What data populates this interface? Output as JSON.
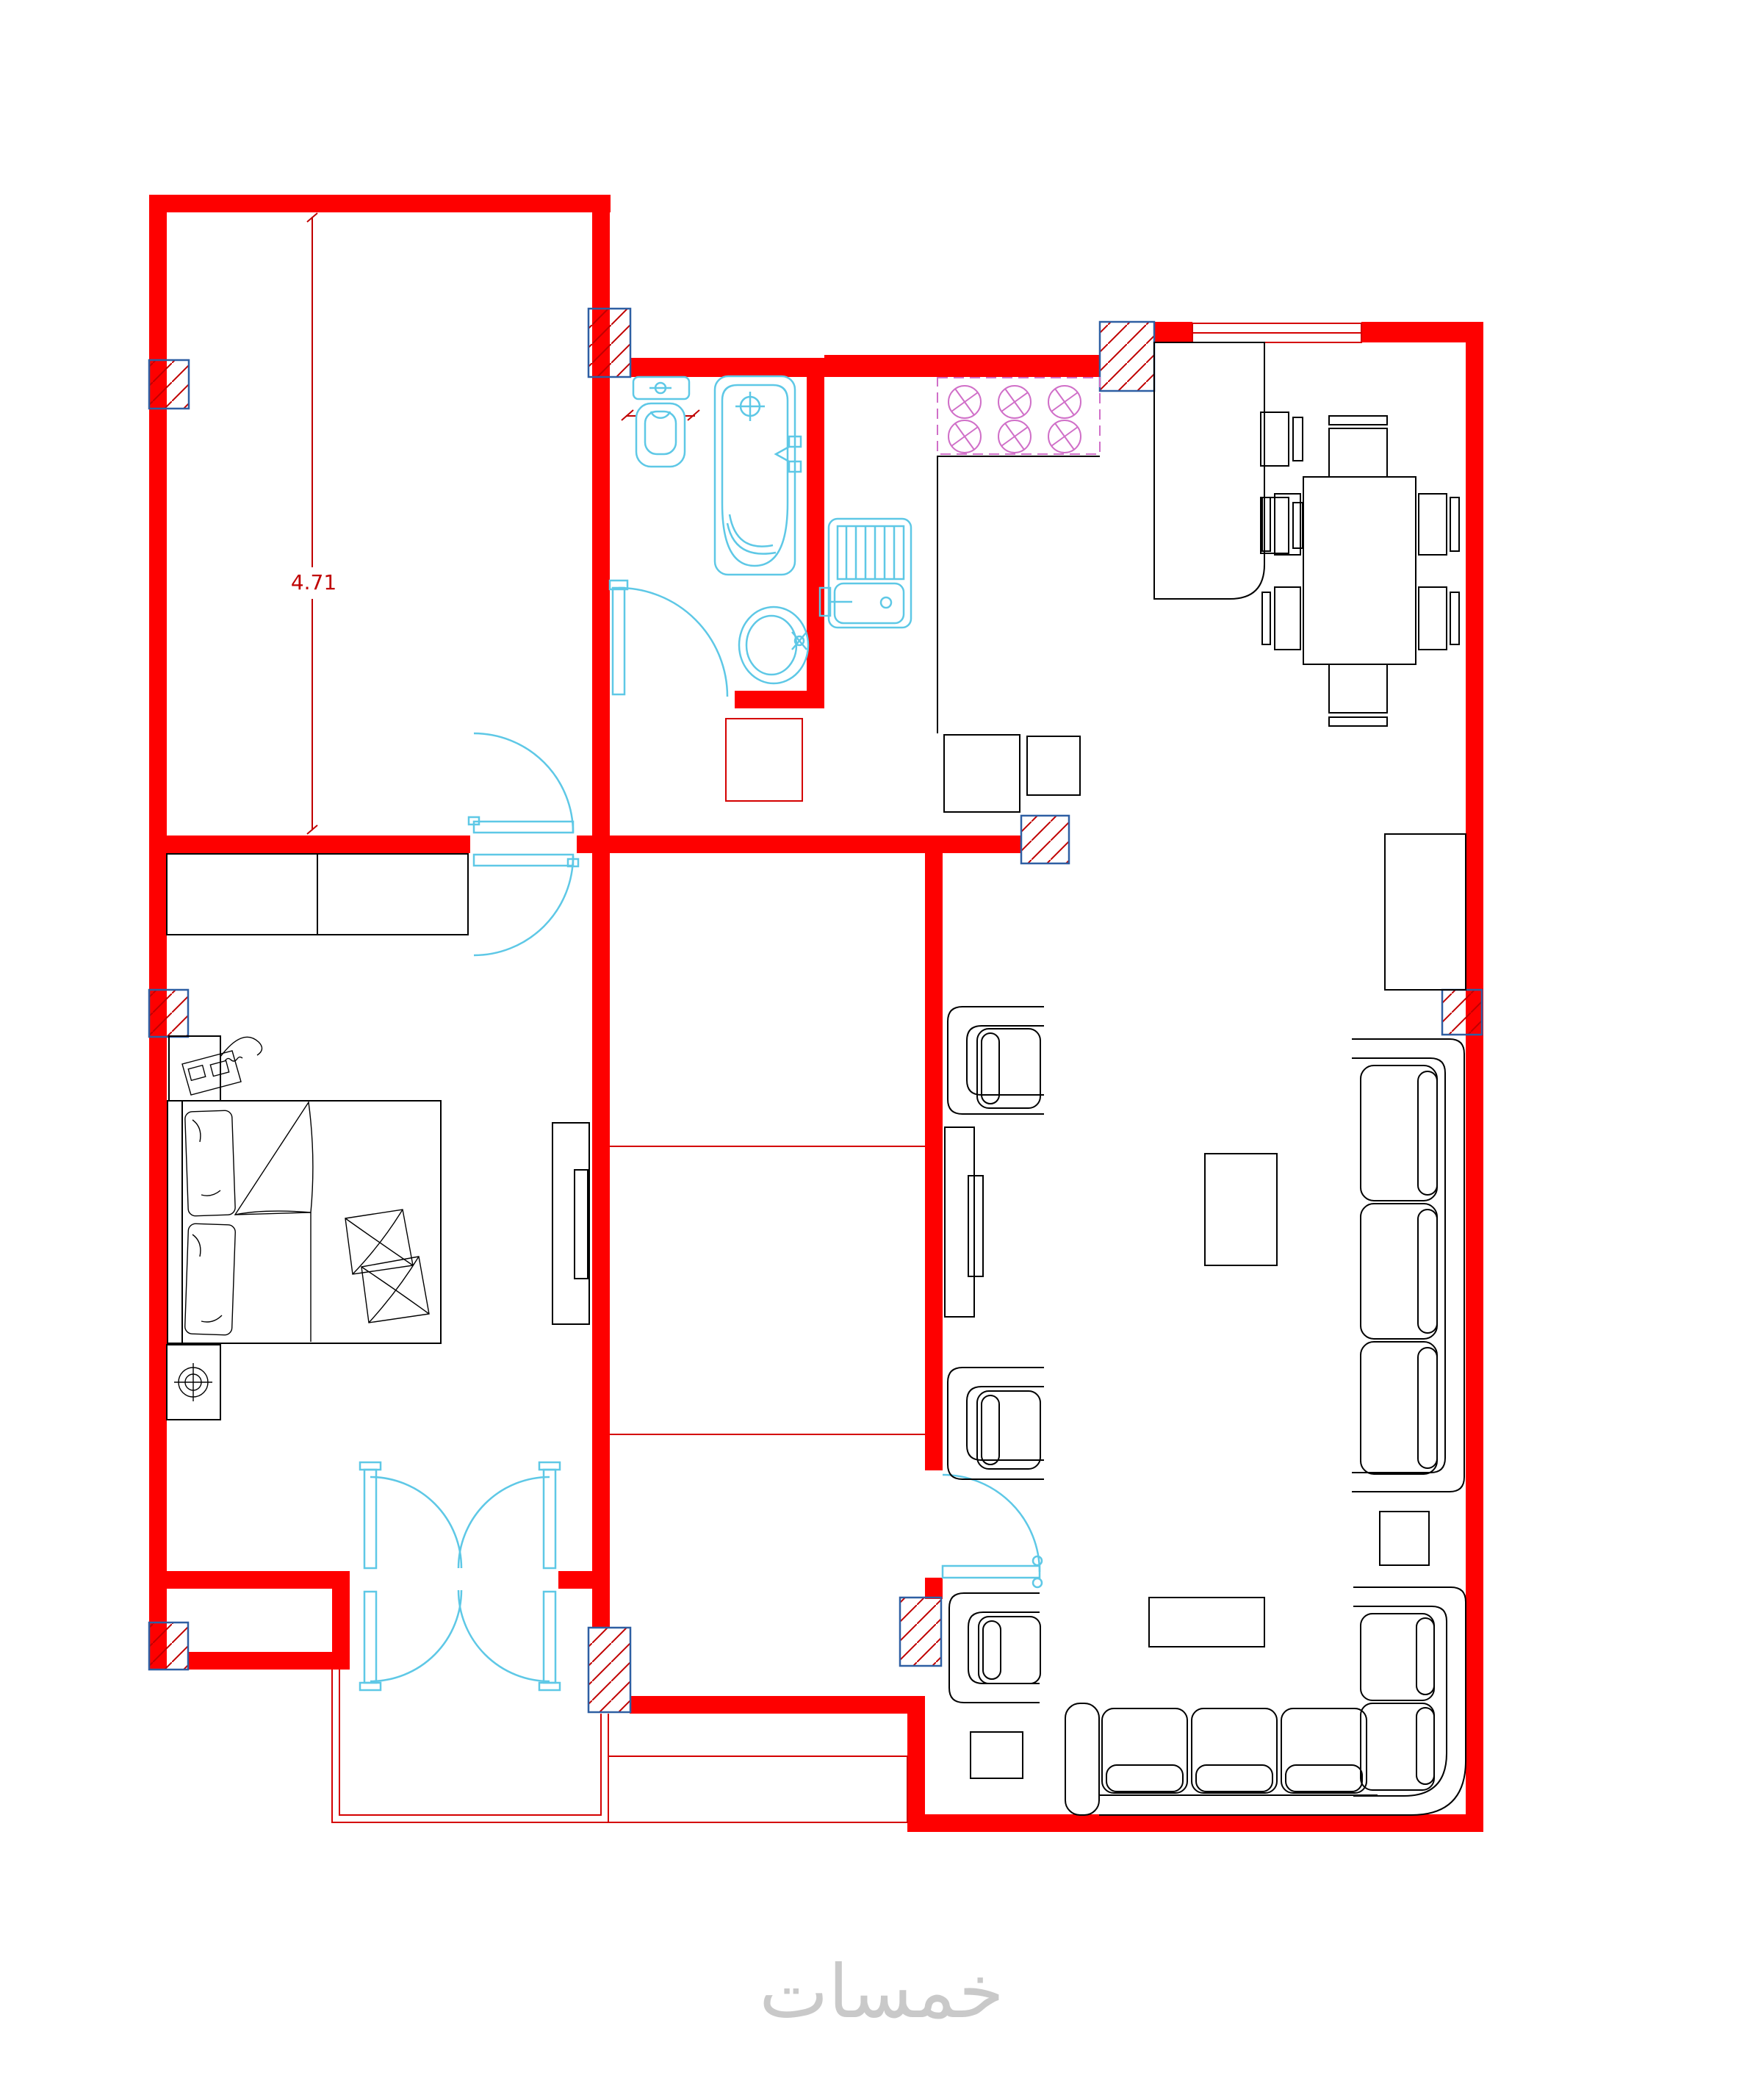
{
  "labels": {
    "room_height_dim": "4.71",
    "toilet_width_dim": "0.43",
    "watermark": "خمسات"
  },
  "colors": {
    "background": "#ffffff",
    "wall": "#fe0000",
    "thin_line": "#d40000",
    "dim_text": "#c00000",
    "fixture": "#5ec8e6",
    "stove": "#d06fc8",
    "furniture": "#000000",
    "hatch_border": "#2e5fa3",
    "hatch_line": "#c00000",
    "watermark": "#c9c9c9"
  }
}
